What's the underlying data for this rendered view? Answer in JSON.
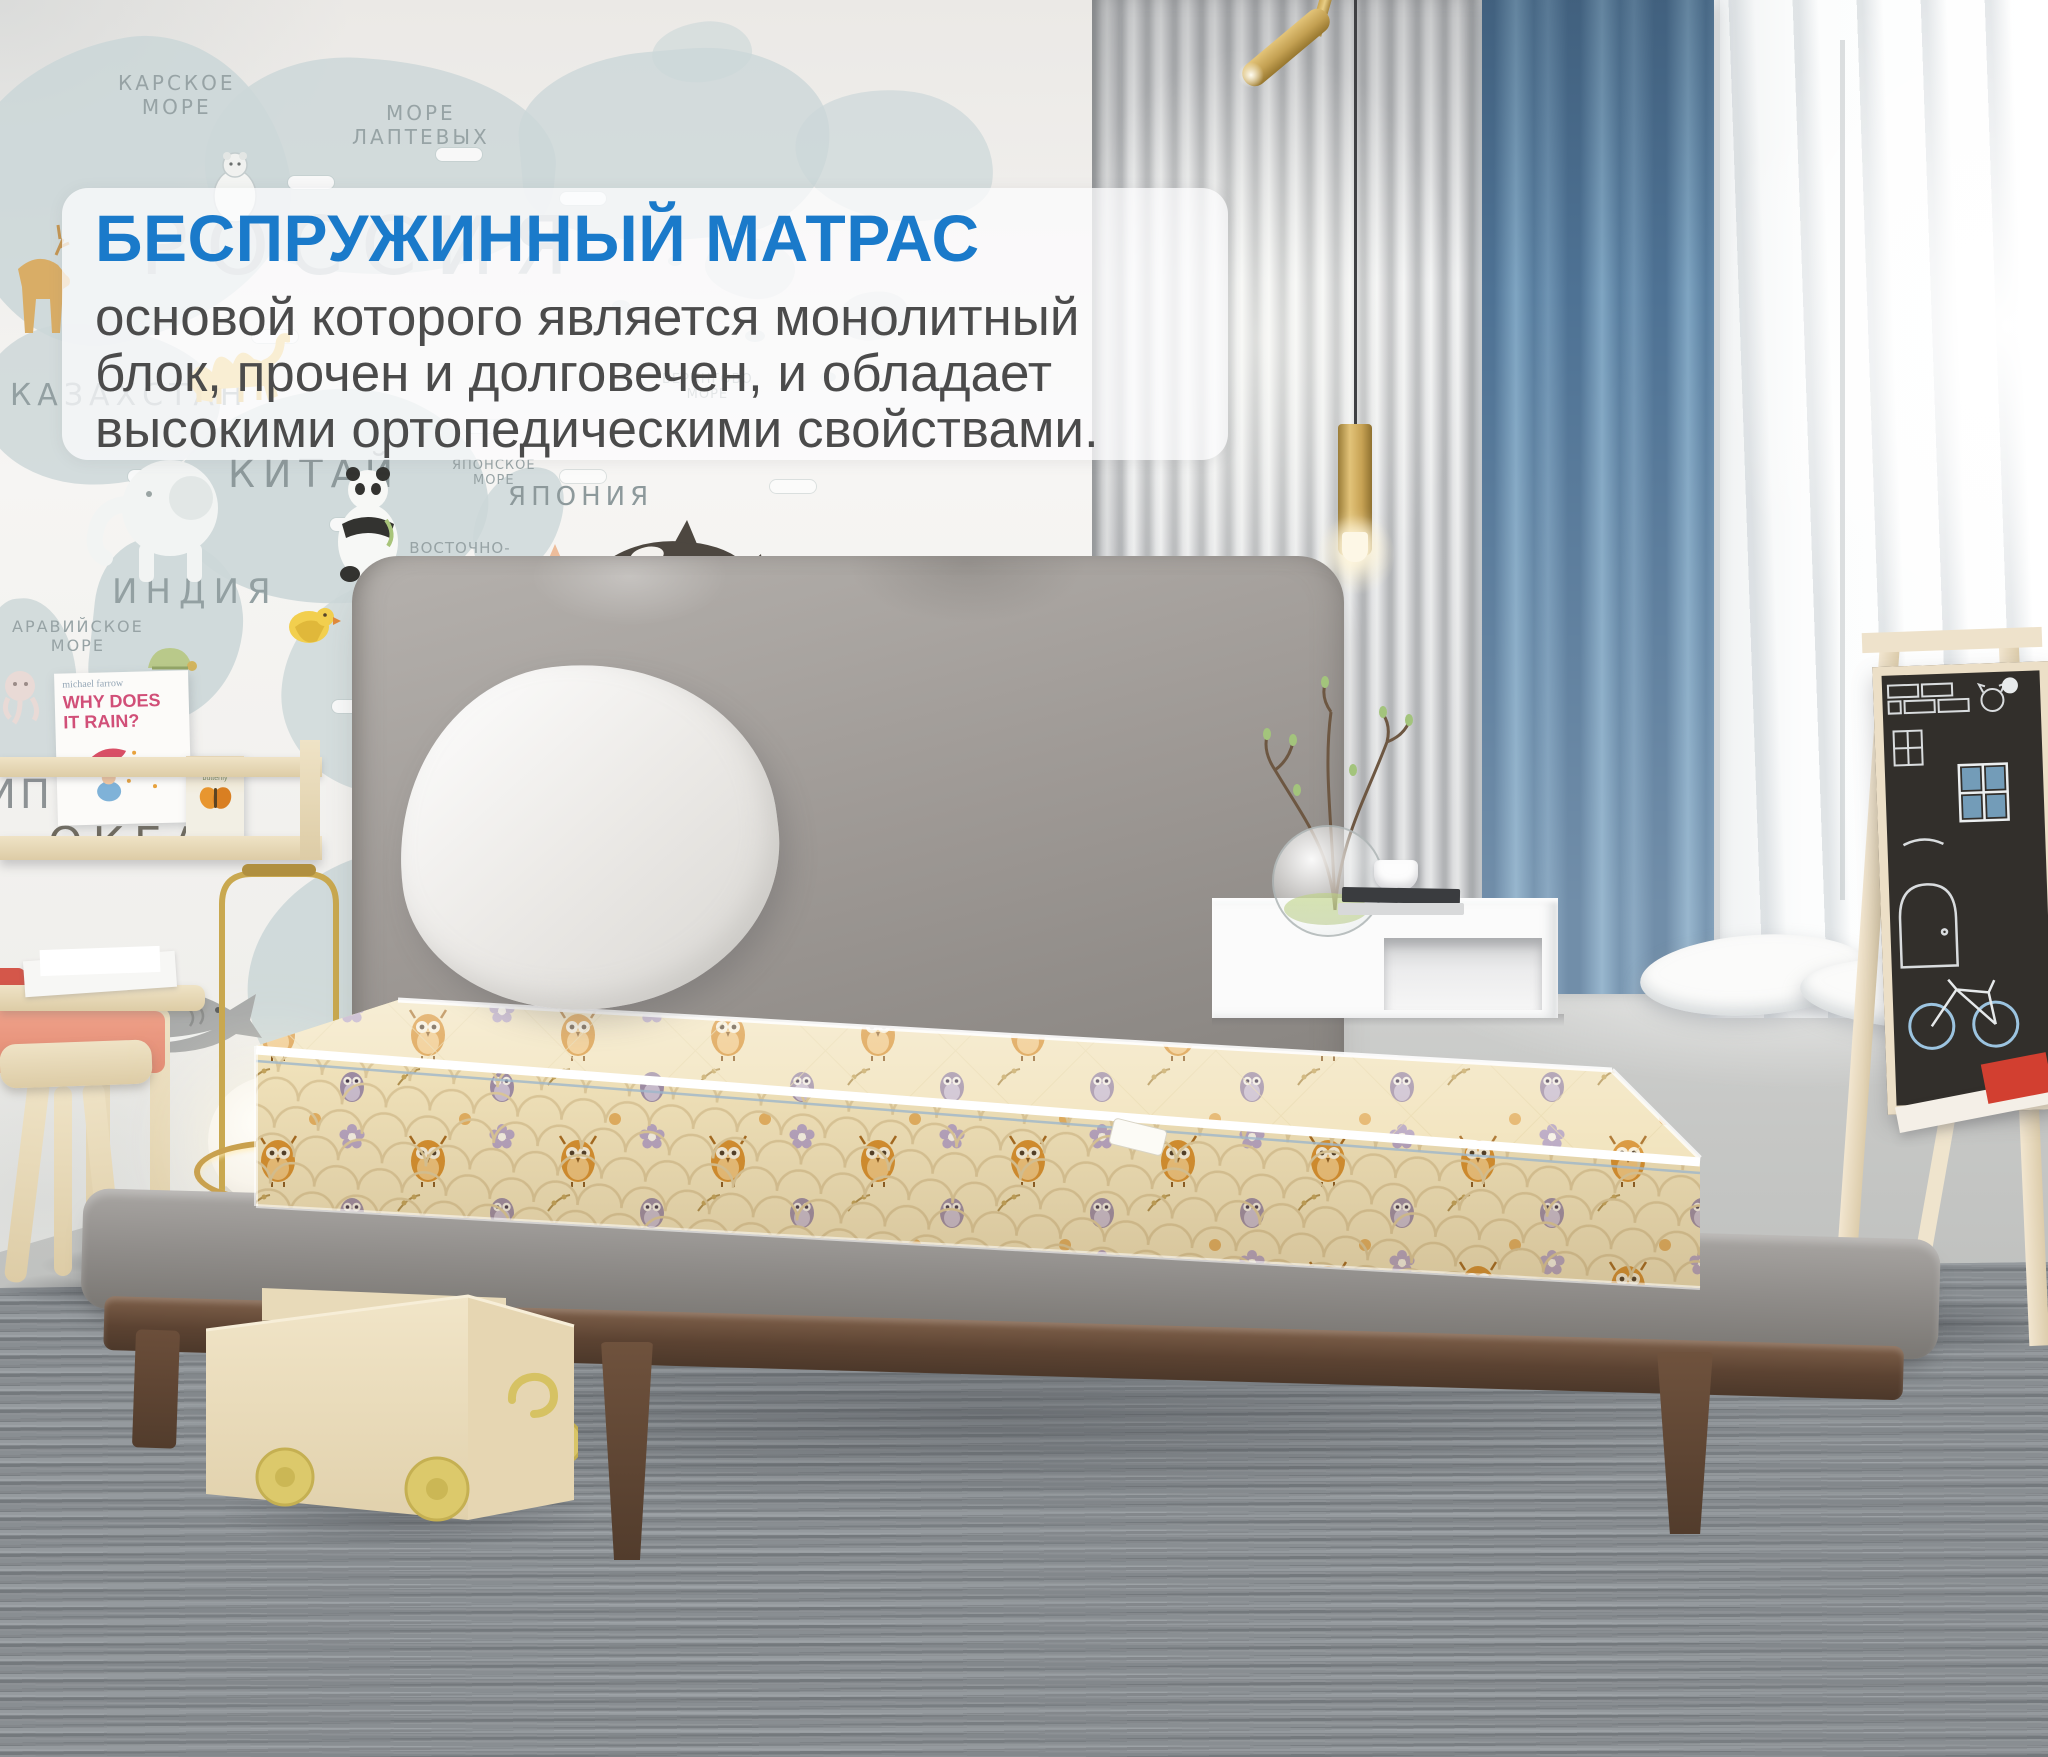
{
  "overlay": {
    "title": "БЕСПРУЖИННЫЙ МАТРАС",
    "line1": "основой которого является монолитный",
    "line2": "блок, прочен и долговечен, и обладает",
    "line3": "высокими ортопедическими свойствами."
  },
  "colors": {
    "title_blue": "#1a7aca",
    "body_gray": "#4b4b4b",
    "curtain_blue": "#5d82a3",
    "mattress_cream": "#f2e4bd",
    "owl_orange": "#d78f2e"
  },
  "map_wall": {
    "russia": "РОССИЯ",
    "kara_sea": "КАРСКОЕ\nМОРЕ",
    "laptev_sea": "МОРЕ\nЛАПТЕВЫХ",
    "bering_sea": "БЕРИНГОВО\nМОРЕ",
    "kazakhstan": "КАЗАХСТАН",
    "china": "КИТАЙ",
    "india": "ИНДИЯ",
    "japan": "ЯПОНИЯ",
    "japan_sea": "ЯПОНСКОЕ\nМОРЕ",
    "arabian_sea": "АРАВИЙСКОЕ\nМОРЕ",
    "east_china_sea": "ВОСТОЧНО-\nКИТАЙСКОЕ\nМОРЕ",
    "philippine_sea": "ФИЛИППИНСКОЕ\nМОРЕ",
    "pacific_ocean": "ТИХИЙ\nОКЕАН",
    "ocean": "ОКЕАН",
    "australia_fragment": "АВС",
    "edge_fragment": "ИП"
  },
  "bookshelf": {
    "book1_author": "michael farrow",
    "book1_title": "WHY DOES\nIT RAIN?",
    "book2_title": "gratch",
    "book2_subtitle": "butterfly"
  }
}
